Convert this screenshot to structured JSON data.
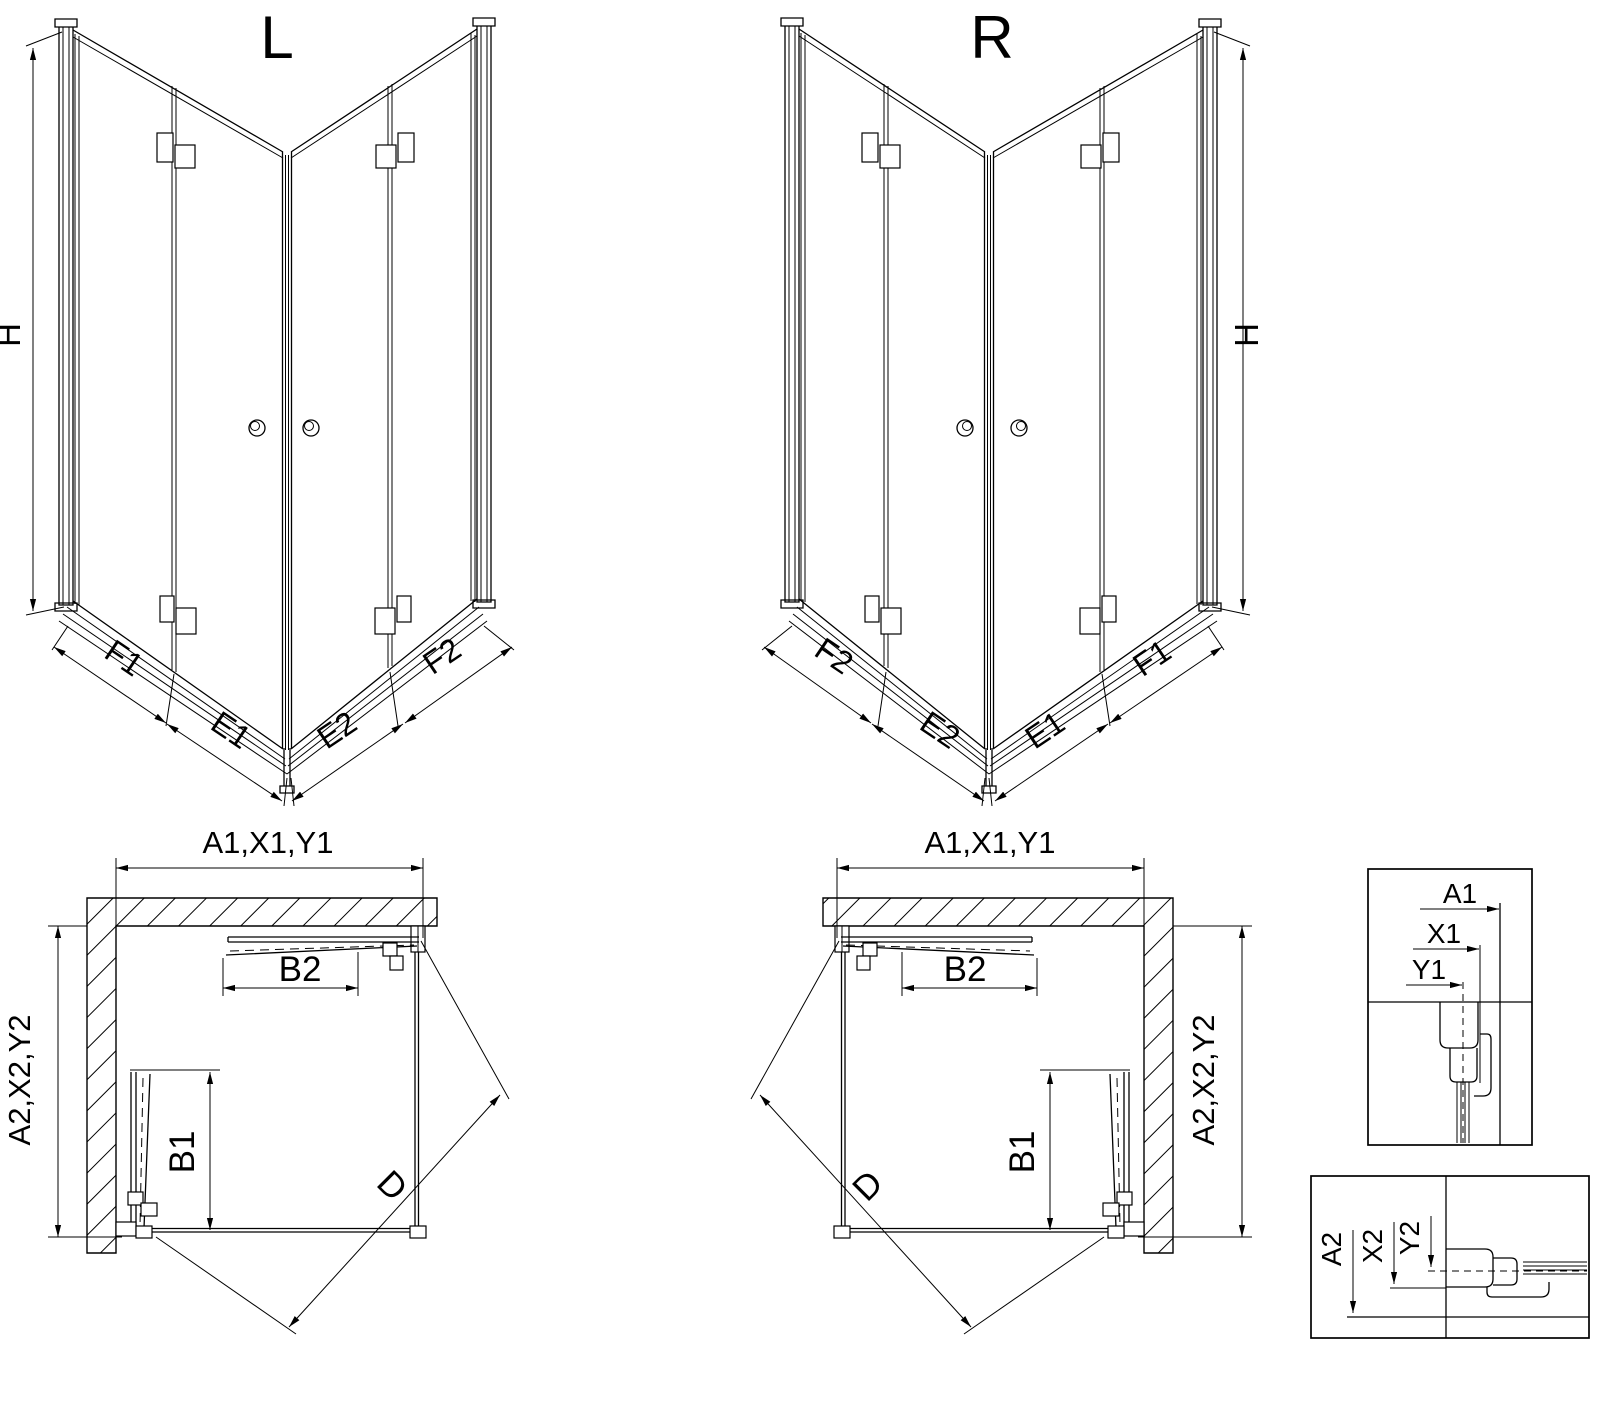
{
  "drawing": {
    "background_color": "#ffffff",
    "line_color": "#000000",
    "iso_view_left": {
      "title": "L",
      "height_dim": "H",
      "segments_left": [
        "F1",
        "E1"
      ],
      "segments_right": [
        "E2",
        "F2"
      ]
    },
    "iso_view_right": {
      "title": "R",
      "height_dim": "H",
      "segments_left": [
        "F2",
        "E2"
      ],
      "segments_right": [
        "E1",
        "F1"
      ]
    },
    "plan_view_left": {
      "width_dim": "A1,X1,Y1",
      "depth_dim": "A2,X2,Y2",
      "door_front_dim": "B2",
      "door_side_dim": "B1",
      "diagonal_dim": "D"
    },
    "plan_view_right": {
      "width_dim": "A1,X1,Y1",
      "depth_dim": "A2,X2,Y2",
      "door_front_dim": "B2",
      "door_side_dim": "B1",
      "diagonal_dim": "D"
    },
    "detail_horizontal": {
      "dims": [
        "A1",
        "X1",
        "Y1"
      ]
    },
    "detail_vertical": {
      "dims": [
        "A2",
        "X2",
        "Y2"
      ]
    }
  }
}
